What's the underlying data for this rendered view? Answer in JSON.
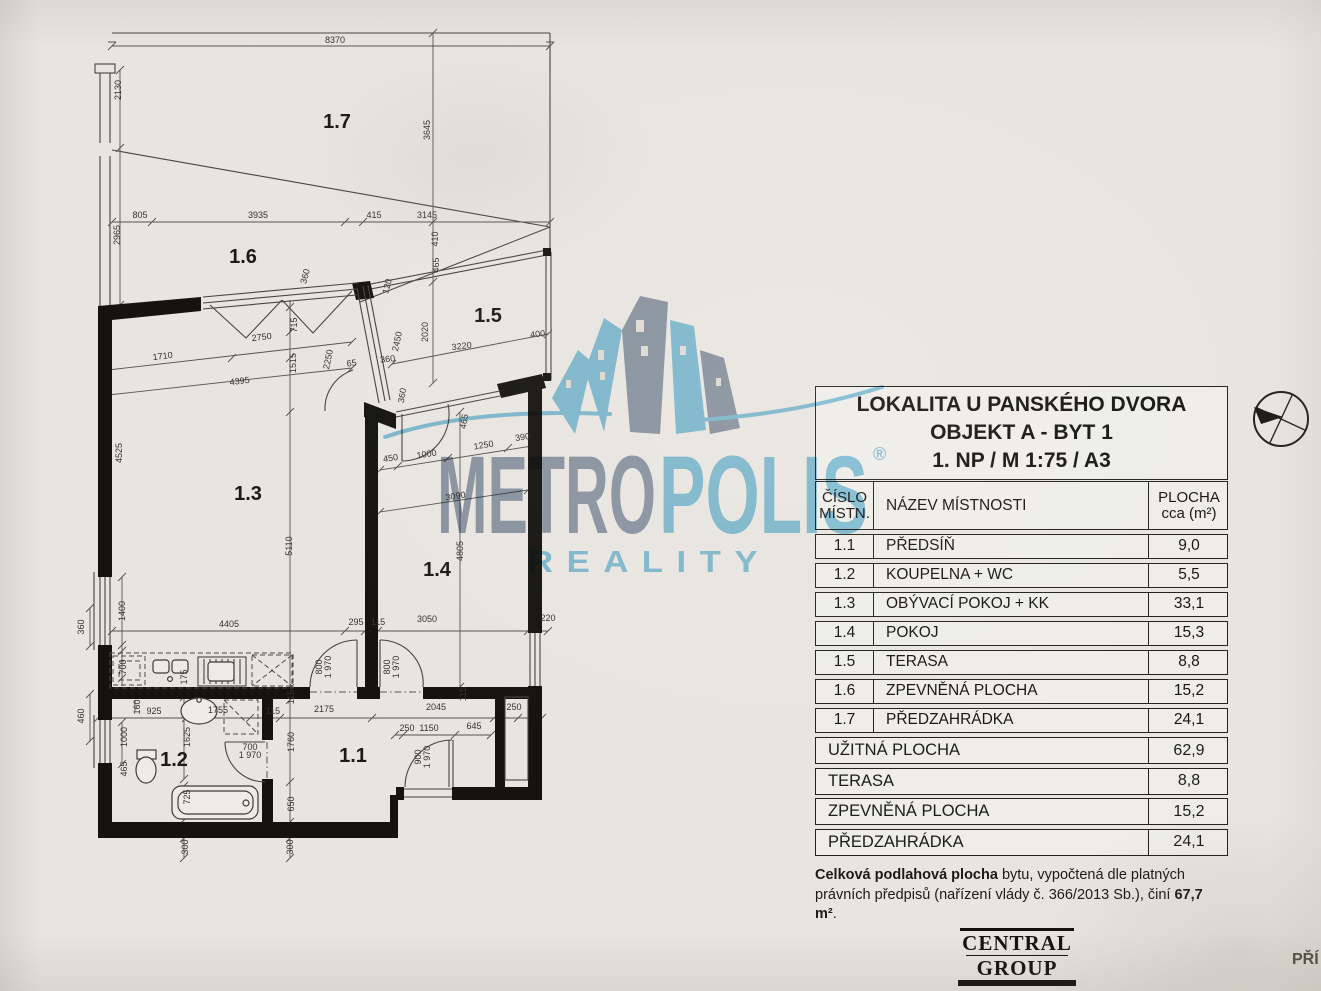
{
  "meta": {
    "paper": "#e8e5e0",
    "ink": "#1c1c1a",
    "logo_blue": "#7fc6e4",
    "logo_gray": "#8b99ac"
  },
  "title_block": {
    "line1": "LOKALITA U PANSKÉHO DVORA",
    "line2": "OBJEKT A - BYT 1",
    "line3": "1. NP / M 1:75 / A3"
  },
  "room_table": {
    "header": {
      "col_number_l1": "ČÍSLO",
      "col_number_l2": "MÍSTN.",
      "col_name": "NÁZEV MÍSTNOSTI",
      "col_area_l1": "PLOCHA",
      "col_area_l2": "cca (m²)"
    },
    "rows": [
      {
        "number": "1.1",
        "name": "PŘEDSÍŇ",
        "area": "9,0"
      },
      {
        "number": "1.2",
        "name": "KOUPELNA + WC",
        "area": "5,5"
      },
      {
        "number": "1.3",
        "name": "OBÝVACÍ POKOJ + KK",
        "area": "33,1"
      },
      {
        "number": "1.4",
        "name": "POKOJ",
        "area": "15,3"
      },
      {
        "number": "1.5",
        "name": "TERASA",
        "area": "8,8"
      },
      {
        "number": "1.6",
        "name": "ZPEVNĚNÁ PLOCHA",
        "area": "15,2"
      },
      {
        "number": "1.7",
        "name": "PŘEDZAHRÁDKA",
        "area": "24,1"
      }
    ],
    "summary": [
      {
        "name": "UŽITNÁ PLOCHA",
        "area": "62,9"
      },
      {
        "name": "TERASA",
        "area": "8,8"
      },
      {
        "name": "ZPEVNĚNÁ PLOCHA",
        "area": "15,2"
      },
      {
        "name": "PŘEDZAHRÁDKA",
        "area": "24,1"
      }
    ]
  },
  "note": {
    "bold_lead": "Celková podlahová plocha",
    "middle": " bytu, vypočtená dle platných právních předpisů (nařízení vlády č. 366/2013 Sb.), činí ",
    "bold_value": "67,7 m²",
    "period": "."
  },
  "watermark": {
    "metro": "METRO",
    "polis": "POLIS",
    "reality": "REALITY",
    "registered": "®"
  },
  "developer_logo": {
    "line1": "CENTRAL",
    "line2": "GROUP"
  },
  "corner_text": "PŘÍ",
  "floorplan": {
    "rooms": [
      {
        "id": "1.7",
        "x": 337,
        "y": 128
      },
      {
        "id": "1.6",
        "x": 243,
        "y": 263
      },
      {
        "id": "1.5",
        "x": 488,
        "y": 322
      },
      {
        "id": "1.3",
        "x": 248,
        "y": 500
      },
      {
        "id": "1.4",
        "x": 437,
        "y": 576
      },
      {
        "id": "1.2",
        "x": 174,
        "y": 766
      },
      {
        "id": "1.1",
        "x": 353,
        "y": 762
      }
    ],
    "dims": [
      {
        "t": "8370",
        "x": 335,
        "y": 43
      },
      {
        "t": "2130",
        "x": 121,
        "y": 90,
        "r": -90
      },
      {
        "t": "3645",
        "x": 430,
        "y": 130,
        "r": -90
      },
      {
        "t": "805",
        "x": 140,
        "y": 218
      },
      {
        "t": "3935",
        "x": 258,
        "y": 218
      },
      {
        "t": "415",
        "x": 374,
        "y": 218
      },
      {
        "t": "3145",
        "x": 427,
        "y": 218
      },
      {
        "t": "2965",
        "x": 120,
        "y": 235,
        "r": -90
      },
      {
        "t": "410",
        "x": 438,
        "y": 239,
        "r": -90
      },
      {
        "t": "465",
        "x": 439,
        "y": 265,
        "r": -90
      },
      {
        "t": "360",
        "x": 308,
        "y": 277,
        "r": -75
      },
      {
        "t": "120",
        "x": 390,
        "y": 287,
        "r": -75
      },
      {
        "t": "715",
        "x": 297,
        "y": 325,
        "r": -90
      },
      {
        "t": "2020",
        "x": 428,
        "y": 332,
        "r": -90
      },
      {
        "t": "2750",
        "x": 262,
        "y": 340,
        "r": -7
      },
      {
        "t": "400",
        "x": 538,
        "y": 337,
        "r": -7
      },
      {
        "t": "3220",
        "x": 462,
        "y": 349,
        "r": -7
      },
      {
        "t": "1710",
        "x": 163,
        "y": 359,
        "r": -7
      },
      {
        "t": "1515",
        "x": 296,
        "y": 363,
        "r": -90
      },
      {
        "t": "2250",
        "x": 331,
        "y": 360,
        "r": -78
      },
      {
        "t": "2450",
        "x": 400,
        "y": 342,
        "r": -78
      },
      {
        "t": "65",
        "x": 352,
        "y": 366,
        "r": -7
      },
      {
        "t": "360",
        "x": 388,
        "y": 362,
        "r": -7
      },
      {
        "t": "4395",
        "x": 240,
        "y": 384,
        "r": -7
      },
      {
        "t": "360",
        "x": 405,
        "y": 396,
        "r": -80
      },
      {
        "t": "465",
        "x": 467,
        "y": 422,
        "r": -80
      },
      {
        "t": "450",
        "x": 391,
        "y": 461,
        "r": -9
      },
      {
        "t": "1000",
        "x": 427,
        "y": 457,
        "r": -9
      },
      {
        "t": "1250",
        "x": 484,
        "y": 448,
        "r": -9
      },
      {
        "t": "390",
        "x": 523,
        "y": 440,
        "r": -9
      },
      {
        "t": "3090",
        "x": 456,
        "y": 499,
        "r": -9
      },
      {
        "t": "4525",
        "x": 122,
        "y": 453,
        "r": -90
      },
      {
        "t": "5110",
        "x": 292,
        "y": 546,
        "r": -90
      },
      {
        "t": "4805",
        "x": 463,
        "y": 551,
        "r": -90
      },
      {
        "t": "1400",
        "x": 125,
        "y": 611,
        "r": -90
      },
      {
        "t": "4405",
        "x": 229,
        "y": 627
      },
      {
        "t": "295",
        "x": 356,
        "y": 625
      },
      {
        "t": "115",
        "x": 378,
        "y": 625
      },
      {
        "t": "3050",
        "x": 427,
        "y": 622
      },
      {
        "t": "220",
        "x": 548,
        "y": 621
      },
      {
        "t": "700",
        "x": 126,
        "y": 667,
        "r": -90
      },
      {
        "t": "175",
        "x": 187,
        "y": 677,
        "r": -90
      },
      {
        "t": "800",
        "x": 322,
        "y": 667,
        "r": -90
      },
      {
        "t": "1 970",
        "x": 331,
        "y": 667,
        "r": -90,
        "s": 7
      },
      {
        "t": "800",
        "x": 390,
        "y": 667,
        "r": -90
      },
      {
        "t": "1 970",
        "x": 399,
        "y": 667,
        "r": -90,
        "s": 7
      },
      {
        "t": "115",
        "x": 294,
        "y": 697,
        "r": -90
      },
      {
        "t": "115",
        "x": 466,
        "y": 694,
        "r": -90
      },
      {
        "t": "360",
        "x": 84,
        "y": 627,
        "r": -90
      },
      {
        "t": "460",
        "x": 84,
        "y": 716,
        "r": -90
      },
      {
        "t": "925",
        "x": 154,
        "y": 714
      },
      {
        "t": "160",
        "x": 140,
        "y": 707,
        "r": -90
      },
      {
        "t": "1755",
        "x": 218,
        "y": 713
      },
      {
        "t": "115",
        "x": 273,
        "y": 714
      },
      {
        "t": "2175",
        "x": 324,
        "y": 712
      },
      {
        "t": "2045",
        "x": 436,
        "y": 710
      },
      {
        "t": "250",
        "x": 514,
        "y": 710
      },
      {
        "t": "1000",
        "x": 127,
        "y": 737,
        "r": -90
      },
      {
        "t": "1625",
        "x": 190,
        "y": 737,
        "r": -90
      },
      {
        "t": "250",
        "x": 407,
        "y": 731
      },
      {
        "t": "1150",
        "x": 429,
        "y": 731
      },
      {
        "t": "645",
        "x": 474,
        "y": 729
      },
      {
        "t": "700",
        "x": 250,
        "y": 750,
        "s": 8
      },
      {
        "t": "1 970",
        "x": 250,
        "y": 758,
        "s": 7
      },
      {
        "t": "1760",
        "x": 294,
        "y": 742,
        "r": -90
      },
      {
        "t": "900",
        "x": 421,
        "y": 757,
        "r": -90
      },
      {
        "t": "1 970",
        "x": 430,
        "y": 757,
        "r": -90,
        "s": 7
      },
      {
        "t": "465",
        "x": 127,
        "y": 769,
        "r": -90
      },
      {
        "t": "725",
        "x": 190,
        "y": 797,
        "r": -90
      },
      {
        "t": "650",
        "x": 294,
        "y": 804,
        "r": -90
      },
      {
        "t": "300",
        "x": 188,
        "y": 847,
        "r": -90
      },
      {
        "t": "300",
        "x": 293,
        "y": 847,
        "r": -90
      }
    ]
  }
}
